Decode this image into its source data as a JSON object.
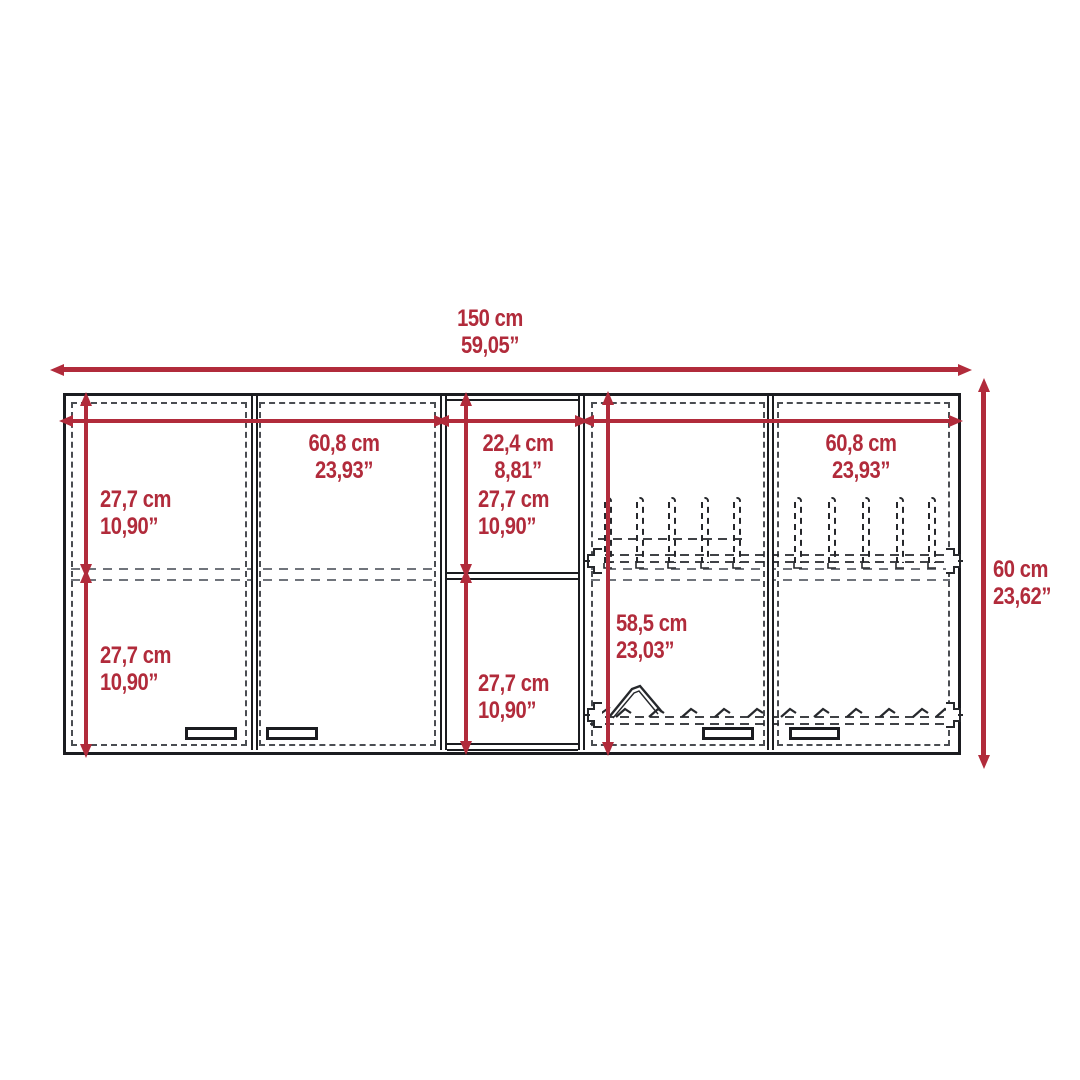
{
  "colors": {
    "dimension_red": "#b12b3b",
    "outline_black": "#1b1c20",
    "hidden_line_gray": "#4a4d52",
    "background": "#ffffff"
  },
  "diagram": {
    "subject": "wall-cabinet-front-elevation",
    "dimensions": {
      "overall_width": {
        "cm": "150 cm",
        "inches": "59,05”"
      },
      "overall_height": {
        "cm": "60 cm",
        "inches": "23,62”"
      },
      "left_section_width": {
        "cm": "60,8 cm",
        "inches": "23,93”"
      },
      "center_section_width": {
        "cm": "22,4 cm",
        "inches": "8,81”"
      },
      "right_section_width": {
        "cm": "60,8 cm",
        "inches": "23,93”"
      },
      "left_upper_height": {
        "cm": "27,7 cm",
        "inches": "10,90”"
      },
      "left_lower_height": {
        "cm": "27,7 cm",
        "inches": "10,90”"
      },
      "center_upper_height": {
        "cm": "27,7 cm",
        "inches": "10,90”"
      },
      "center_lower_height": {
        "cm": "27,7 cm",
        "inches": "10,90”"
      },
      "right_interior_height": {
        "cm": "58,5 cm",
        "inches": "23,03”"
      }
    }
  }
}
